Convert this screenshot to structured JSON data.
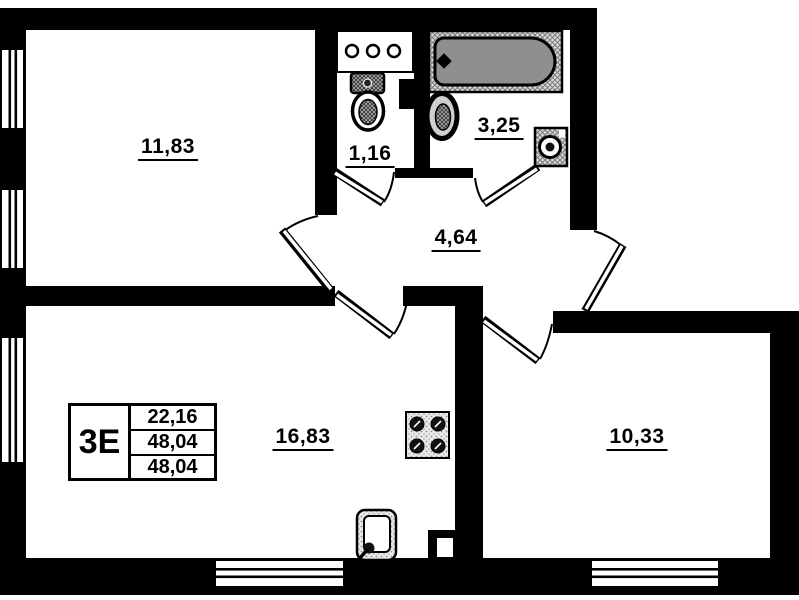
{
  "plan_type": "apartment-floor-plan",
  "rooms": [
    {
      "name": "room-top-left",
      "area": "11,83"
    },
    {
      "name": "wc",
      "area": "1,16"
    },
    {
      "name": "bathroom",
      "area": "3,25"
    },
    {
      "name": "hallway",
      "area": "4,64"
    },
    {
      "name": "kitchen-living",
      "area": "16,83"
    },
    {
      "name": "bedroom",
      "area": "10,33"
    }
  ],
  "info_box": {
    "type_label": "3Е",
    "rows": [
      "22,16",
      "48,04",
      "48,04"
    ]
  },
  "fixtures": [
    "bathtub-icon",
    "wash-basin-icon",
    "toilet-icon",
    "washing-machine-icon",
    "shelf-with-meters-icon",
    "stove-icon",
    "kitchen-sink-icon",
    "vent-shaft-icon"
  ],
  "colors": {
    "wall": "#000000",
    "floor": "#ffffff",
    "tub_fill": "#8f8f8f",
    "texture": "#8a8a8a"
  }
}
